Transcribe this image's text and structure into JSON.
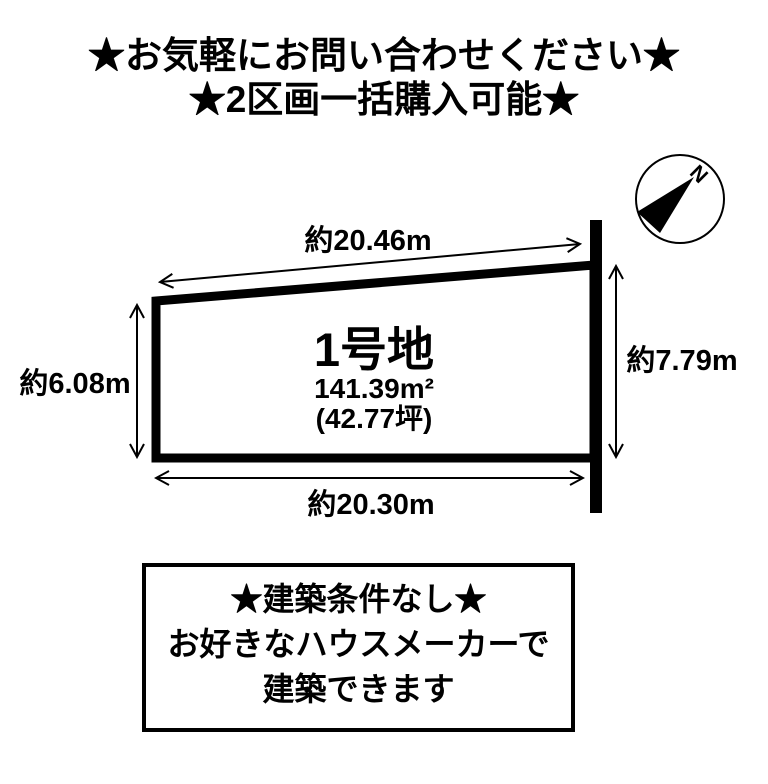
{
  "page": {
    "background_color": "#ffffff",
    "ink_color": "#000000"
  },
  "header": {
    "line1": "★お気軽にお問い合わせください★",
    "line2": "★2区画一括購入可能★"
  },
  "compass": {
    "north_label": "N"
  },
  "plot": {
    "name": "1号地",
    "area_sqm": "141.39m²",
    "area_tsubo": "(42.77坪)",
    "dim_top": "約20.46m",
    "dim_left": "約6.08m",
    "dim_right": "約7.79m",
    "dim_bottom": "約20.30m"
  },
  "notice_box": {
    "line1": "★建築条件なし★",
    "line2": "お好きなハウスメーカーで",
    "line3": "建築できます"
  }
}
